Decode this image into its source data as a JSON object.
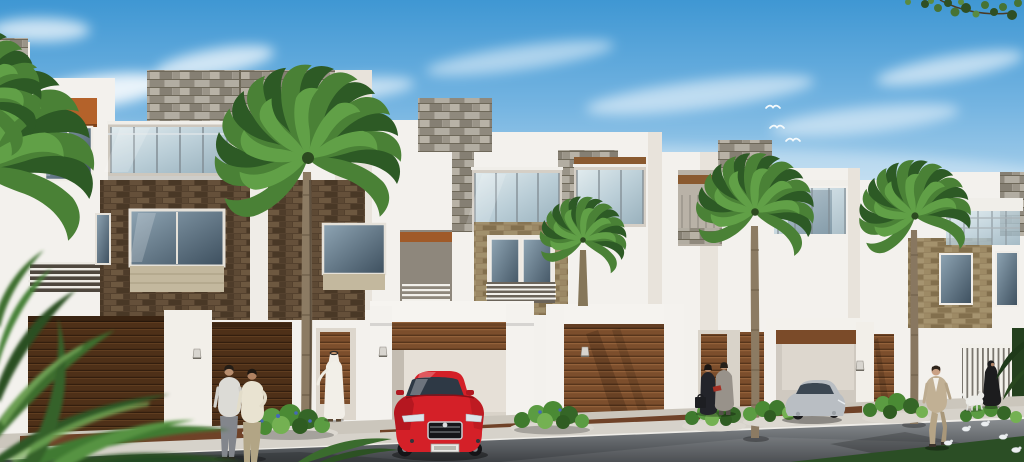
{
  "scene": {
    "type": "architectural-rendering",
    "description": "Sunny 3D visualization of a row of modern white townhouses with gray stone roof blocks, dark brick and tan stone cladding, glass balcony railings, timber slat garage doors, palm trees, landscaped sidewalk bushes, pedestrians, a red sedan parked at an open garage and a silver car inside a right-hand garage",
    "sky": "blue with soft diagonal white clouds",
    "time_of_day": "day"
  },
  "palette": {
    "sky_top": "#3f97d3",
    "sky_horizon": "#e4eff7",
    "cloud_white": "#ffffff",
    "wall_white": "#f3f1ed",
    "wall_shade": "#e8e3db",
    "stone_gray": "#a29c91",
    "brick_dark": "#54412e",
    "brick_tan": "#a8956d",
    "wood_door": "#7c4e2c",
    "wood_door_dark": "#4e3018",
    "accent_orange": "#b4622a",
    "soffit_brown": "#8a5a30",
    "glass_balcony": "#cfe0e8",
    "glass_window": "#46596a",
    "palm_green": "#4a8136",
    "palm_trunk": "#8c7b63",
    "bush_green": "#4a8a34",
    "grass_dark": "#2b4e25",
    "road_gray": "#6f7478",
    "sidewalk": "#d6d2ca",
    "driveway_brown": "#6f4228",
    "car_red": "#d42028",
    "car_silver": "#b9bec3",
    "shirt_gray": "#dcdbd6",
    "shirt_cream": "#e9e3d1",
    "pants_gray": "#83868c",
    "pants_khaki": "#b2a585",
    "suit_tan": "#c1b094",
    "suit_gray": "#98928a",
    "dress_black": "#23242a",
    "thobe_white": "#f2efe8",
    "abaya_black": "#1c1c1e",
    "dog_white": "#ecece8"
  },
  "objects": {
    "buildings": {
      "count": 6,
      "style": "modern flat-roof townhouses",
      "features": [
        "gray stone roof blocks",
        "glass balcony railings",
        "dark brown brick facade with large windows",
        "tan stone window surround",
        "orange accent band",
        "timber slat garage doors",
        "wall sconce lamps",
        "white vertical-slat gate"
      ]
    },
    "palm_trees": {
      "count": 4,
      "left_edge_fronds": true,
      "foreground_blurred_plant": true
    },
    "vehicles": [
      {
        "name": "red-sedan",
        "color": "#d42028",
        "position": "parked facing street at open center garage"
      },
      {
        "name": "silver-car",
        "color": "#b9bec3",
        "position": "inside right garage"
      }
    ],
    "people": [
      {
        "name": "two-men-from-behind",
        "detail": "light shirts, gray and khaki trousers, center-left"
      },
      {
        "name": "man-in-white-thobe",
        "detail": "standing at an entrance door"
      },
      {
        "name": "couple-talking",
        "detail": "woman in black with briefcase, man in gray suit"
      },
      {
        "name": "man-in-tan-suit",
        "detail": "walking on the road, right side"
      },
      {
        "name": "woman-in-black-abaya",
        "detail": "walking right with a white dog"
      }
    ],
    "animals": {
      "white_dog": 1,
      "gulls_flying": 3,
      "birds_on_road": 5
    },
    "landscaping": {
      "street_bushes": 6,
      "flower_color": "#4468b8",
      "overhanging_branch": "top-right corner",
      "dark_grass": "bottom-right corner"
    }
  }
}
